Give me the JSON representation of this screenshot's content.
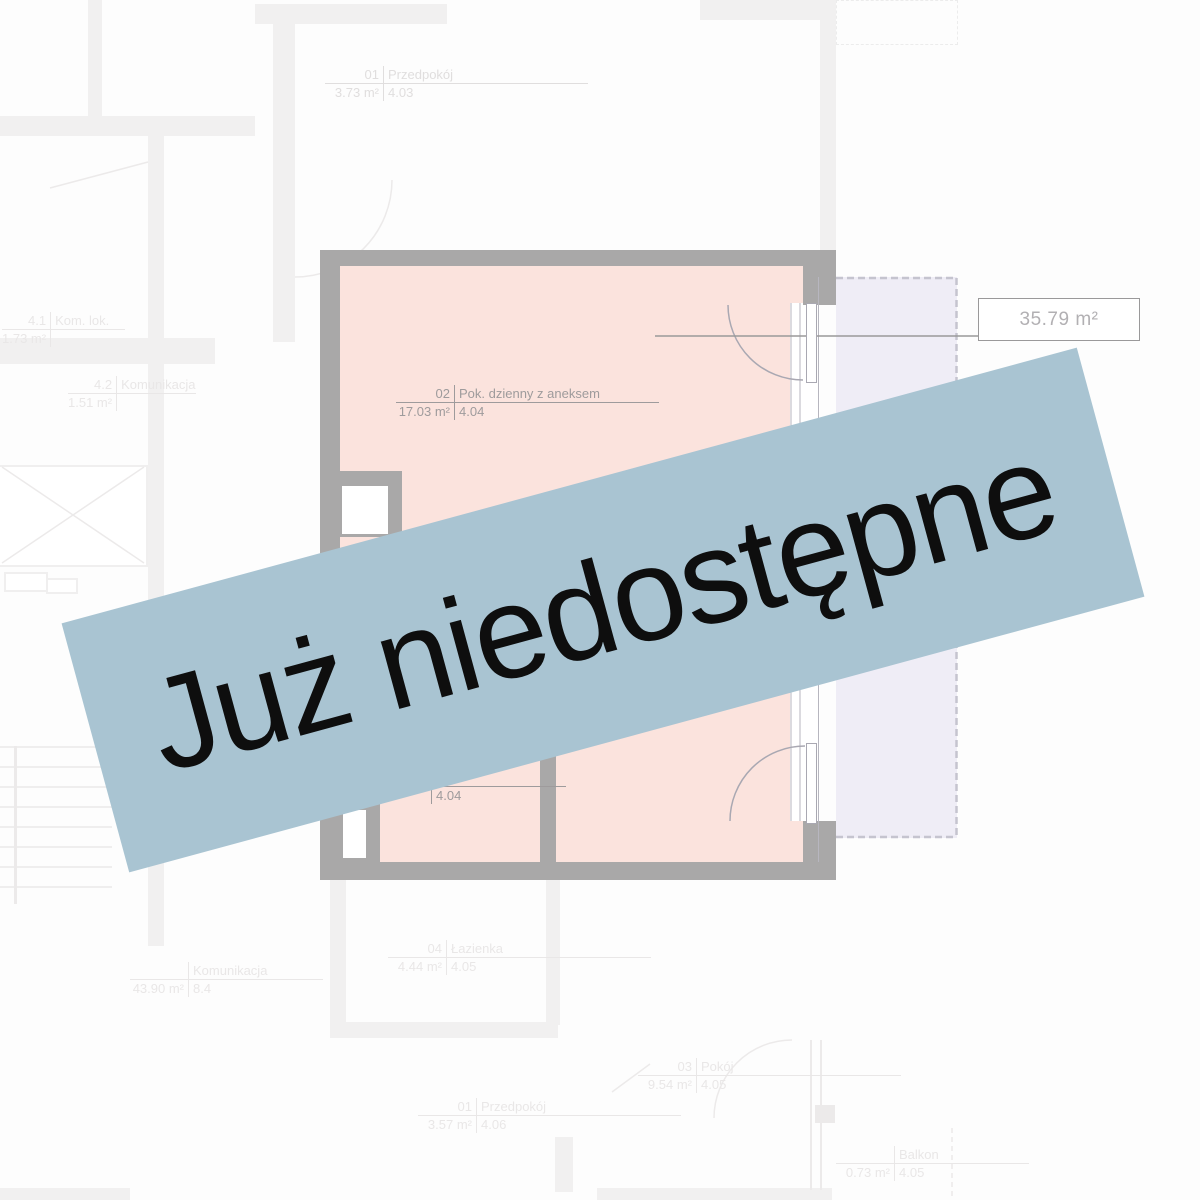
{
  "banner": {
    "label": "Już niedostępne"
  },
  "area_box": {
    "label": "35.79 m²"
  },
  "unit": {
    "rooms": [
      {
        "number": "02",
        "name": "Pok. dzienny z aneksem",
        "area": "17.03 m²",
        "height": "4.04"
      },
      {
        "number": "",
        "name": "",
        "area": "",
        "height": "4.04"
      }
    ]
  },
  "background_labels": [
    {
      "number": "01",
      "name": "Przedpokój",
      "area": "3.73 m²",
      "height": "4.03"
    },
    {
      "number": "4.1",
      "name": "Kom. lok.",
      "area": "1.73 m²",
      "height": ""
    },
    {
      "number": "4.2",
      "name": "Komunikacja",
      "area": "1.51 m²",
      "height": ""
    },
    {
      "number": "04",
      "name": "Łazienka",
      "area": "4.44 m²",
      "height": "4.05"
    },
    {
      "number": "",
      "name": "Komunikacja",
      "area": "43.90 m²",
      "height": "8.4"
    },
    {
      "number": "03",
      "name": "Pokój",
      "area": "9.54 m²",
      "height": "4.05"
    },
    {
      "number": "01",
      "name": "Przedpokój",
      "area": "3.57 m²",
      "height": "4.06"
    },
    {
      "number": "",
      "name": "Balkon",
      "area": "0.73 m²",
      "height": "4.05"
    }
  ],
  "colors": {
    "banner_bg": "#a9c4d2",
    "banner_text": "#0e0e0e",
    "room_fill": "#fbe3dd",
    "wall": "#a9a8a8",
    "balcony_fill": "#efedf6",
    "label_text": "#9e9b9c",
    "area_box_text": "#b2b0b3",
    "faint_line": "#eceaea"
  }
}
